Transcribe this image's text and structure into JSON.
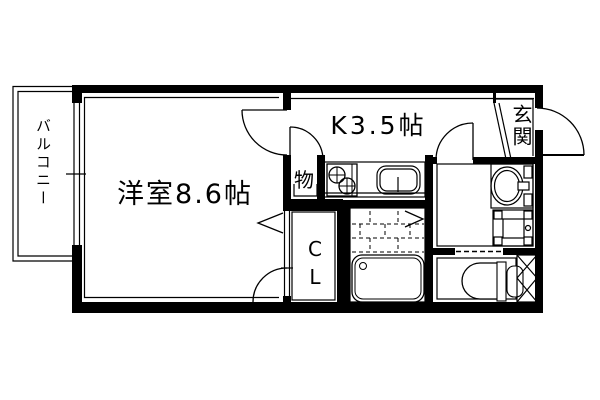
{
  "meta": {
    "type": "japanese-apartment-floor-plan",
    "colors": {
      "line": "#000000",
      "background": "#ffffff"
    }
  },
  "labels": {
    "western_room": "洋室8.6帖",
    "kitchen": "K3.5帖",
    "balcony": "バルコニー",
    "entrance": "玄関",
    "storage": "物",
    "closet": "CL"
  },
  "fixtures": [
    "kitchen-stove-2-burner",
    "kitchen-sink",
    "storage-closet-door",
    "wash-basin",
    "washing-machine-pan",
    "bathtub",
    "bath-folding-door",
    "toilet",
    "pipe-space-hatch",
    "entrance-step",
    "sliding-window",
    "swing-doors"
  ]
}
